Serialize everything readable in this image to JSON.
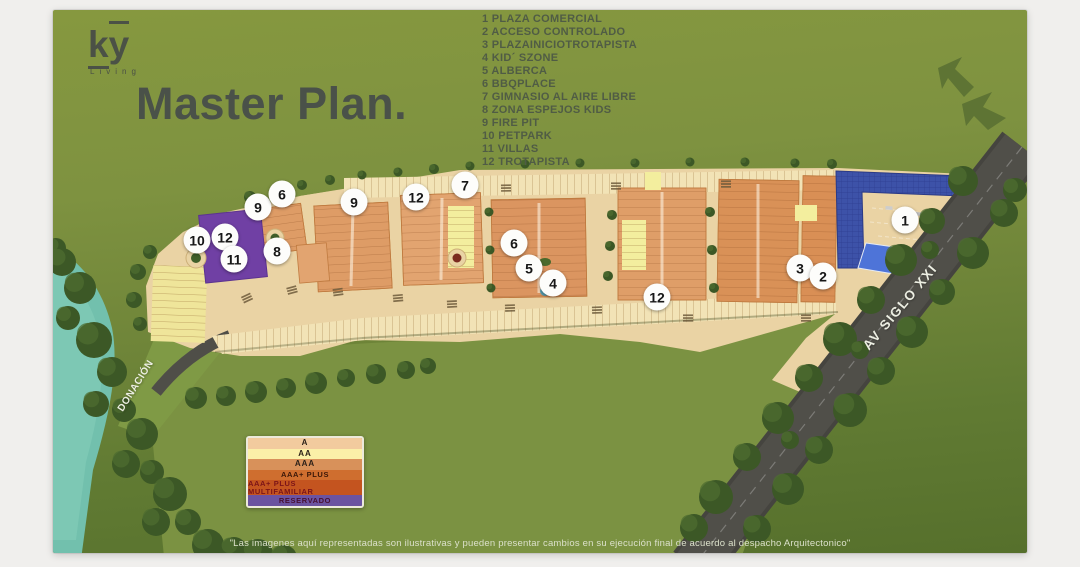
{
  "brand": {
    "name": "ky",
    "tagline": "Living"
  },
  "title": "Master Plan.",
  "amenities": [
    {
      "num": "1",
      "label": "PLAZA COMERCIAL"
    },
    {
      "num": "2",
      "label": "ACCESO CONTROLADO"
    },
    {
      "num": "3",
      "label": "PLAZAINICIOTROTAPISTA"
    },
    {
      "num": "4",
      "label": "KID´ SZONE"
    },
    {
      "num": "5",
      "label": "ALBERCA"
    },
    {
      "num": "6",
      "label": "BBQPLACE"
    },
    {
      "num": "7",
      "label": "GIMNASIO AL AIRE LIBRE"
    },
    {
      "num": "8",
      "label": "ZONA ESPEJOS KIDS"
    },
    {
      "num": "9",
      "label": "FIRE PIT"
    },
    {
      "num": "10",
      "label": "PETPARK"
    },
    {
      "num": "11",
      "label": "VILLAS"
    },
    {
      "num": "12",
      "label": "TROTAPISTA"
    }
  ],
  "map": {
    "road_label": "AV SIGLO XXI",
    "area_label": "DONACIÓN",
    "markers": [
      {
        "n": "10",
        "x": 197,
        "y": 240
      },
      {
        "n": "12",
        "x": 225,
        "y": 237
      },
      {
        "n": "11",
        "x": 234,
        "y": 259
      },
      {
        "n": "9",
        "x": 258,
        "y": 207
      },
      {
        "n": "6",
        "x": 282,
        "y": 194
      },
      {
        "n": "8",
        "x": 277,
        "y": 251
      },
      {
        "n": "9",
        "x": 354,
        "y": 202
      },
      {
        "n": "12",
        "x": 416,
        "y": 197
      },
      {
        "n": "7",
        "x": 465,
        "y": 185
      },
      {
        "n": "6",
        "x": 514,
        "y": 243
      },
      {
        "n": "5",
        "x": 529,
        "y": 268
      },
      {
        "n": "4",
        "x": 553,
        "y": 283
      },
      {
        "n": "12",
        "x": 657,
        "y": 297
      },
      {
        "n": "3",
        "x": 800,
        "y": 268
      },
      {
        "n": "2",
        "x": 823,
        "y": 276
      },
      {
        "n": "1",
        "x": 905,
        "y": 220
      }
    ]
  },
  "legend": {
    "rows": [
      {
        "label": "A",
        "bg": "#f2cb9e",
        "fg": "#2b2018"
      },
      {
        "label": "AA",
        "bg": "#fbf0a8",
        "fg": "#2b2018"
      },
      {
        "label": "AAA",
        "bg": "#d8915a",
        "fg": "#2b2018"
      },
      {
        "label": "AAA+ PLUS",
        "bg": "#cf6e2f",
        "fg": "#3a1708"
      },
      {
        "label": "AAA+ PLUS MULTIFAMILIAR",
        "bg": "#c4541f",
        "fg": "#7c1418"
      },
      {
        "label": "RESERVADO",
        "bg": "#6b53a0",
        "fg": "#471033"
      }
    ]
  },
  "disclaimer": "\"Las imagenes aquí representadas son ilustrativas y pueden presentar cambios en su ejecución final de acuerdo al despacho Arquitectonico\""
}
